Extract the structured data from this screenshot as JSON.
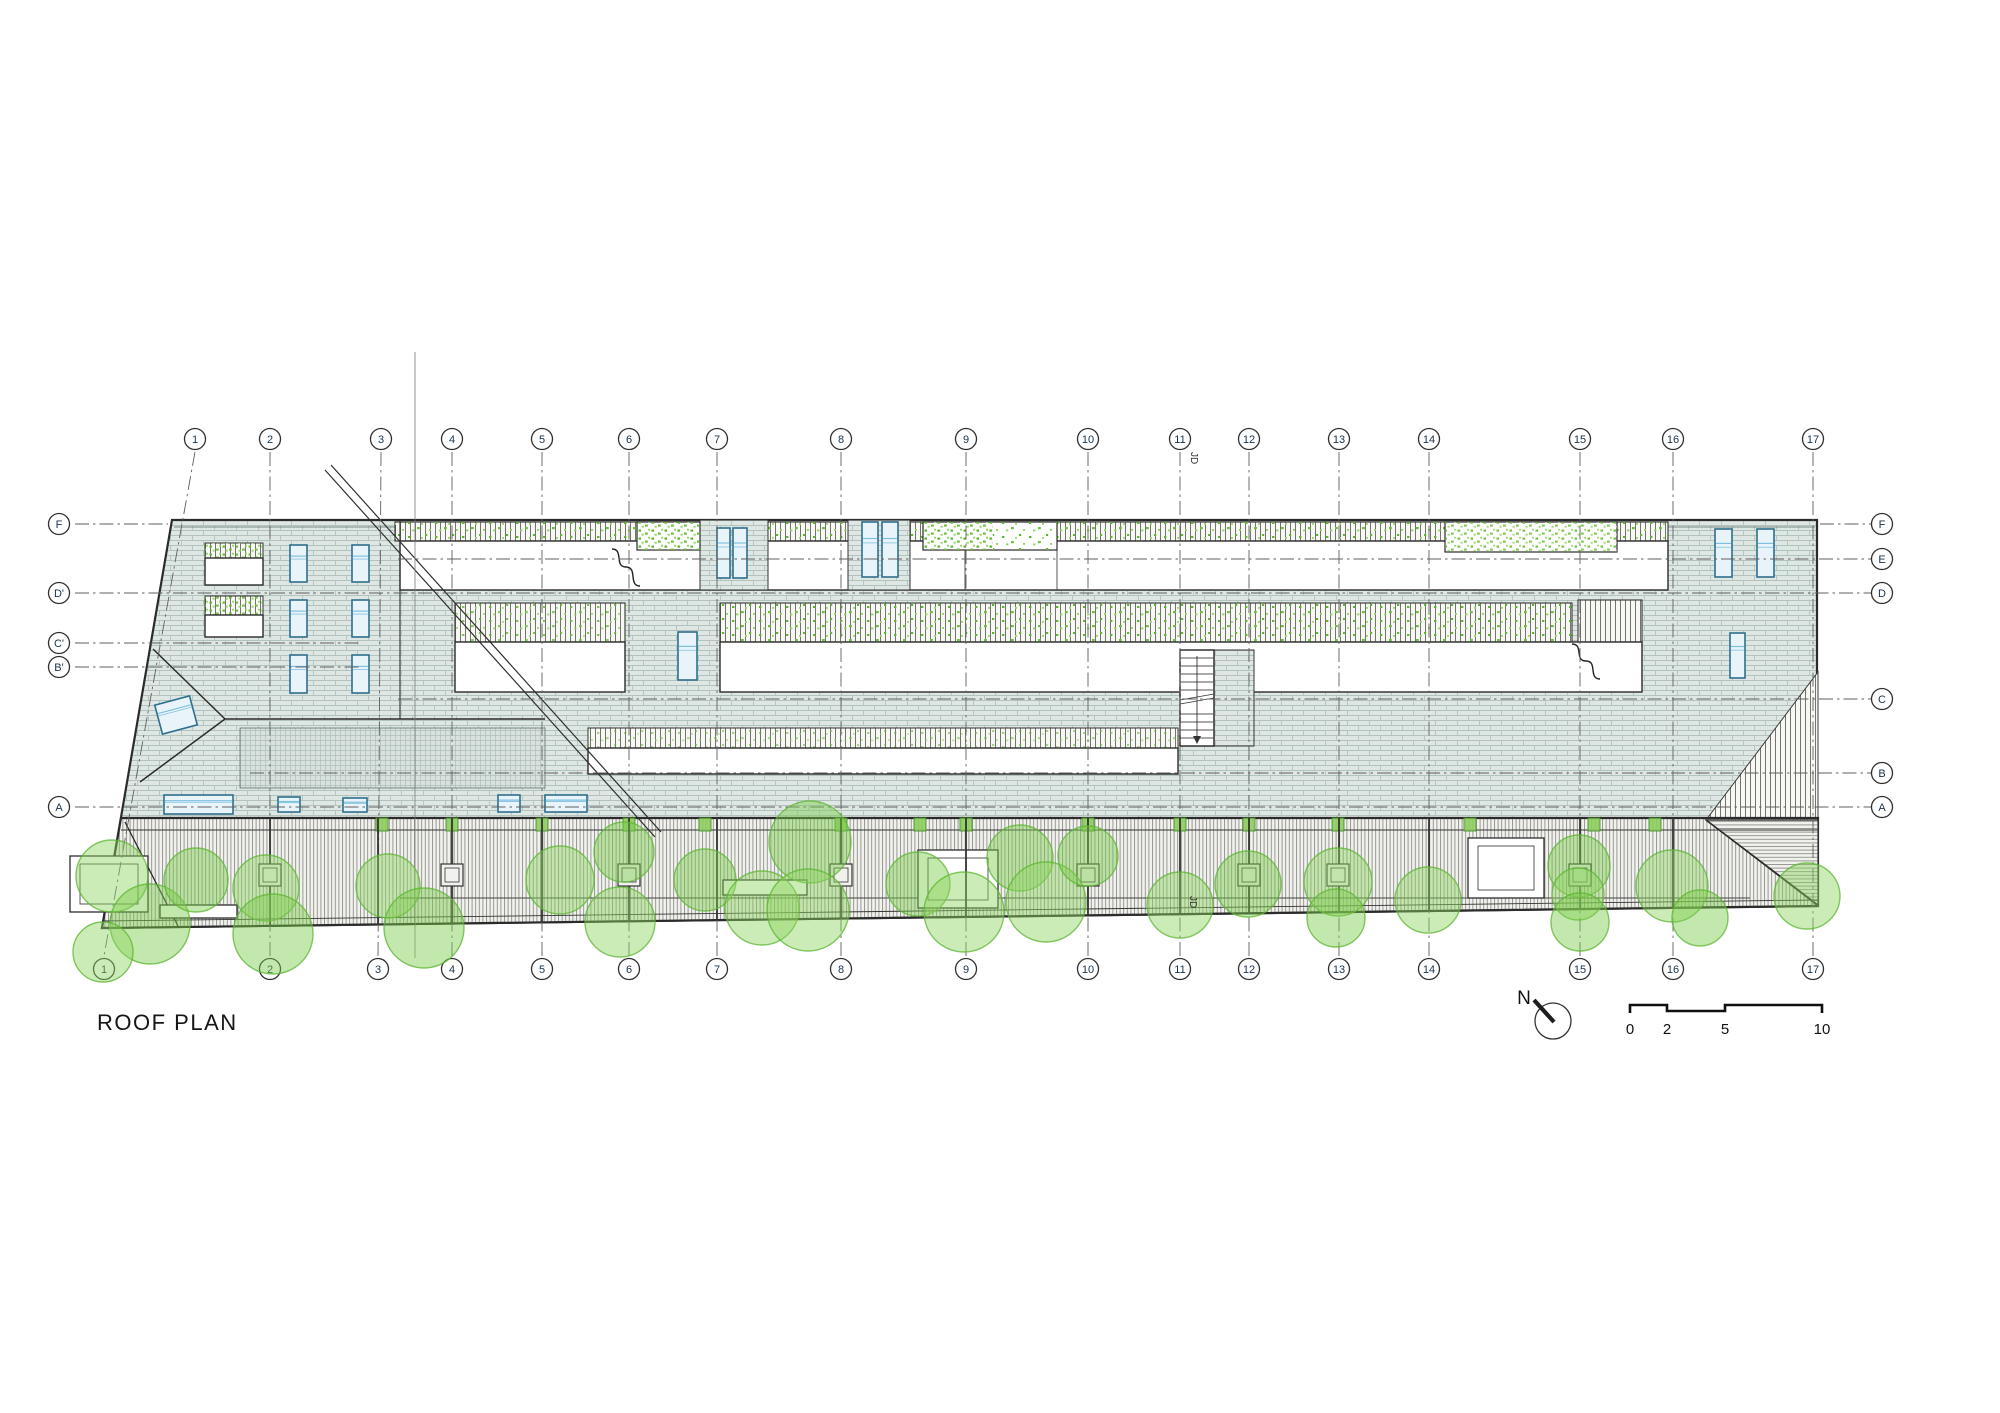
{
  "drawing": {
    "title": "ROOF PLAN",
    "north_label": "N",
    "section_label": "JD"
  },
  "colors": {
    "outline": "#2b2b2b",
    "grid_line": "#5f5f5f",
    "brick_bg": "#dee7e3",
    "brick_joint": "#b2c3bd",
    "deck_bg": "#f1f1ee",
    "deck_stripe": "#8d8d88",
    "green_dot_dark": "#5eb52f",
    "green_dot_light": "#8ed45f",
    "tree_fill": "#8ed45f",
    "tree_stroke": "#5cb631",
    "skylight_frame": "#2f6e8e",
    "skylight_fill": "#e9f4fa",
    "skylight_glaze": "#7fc0e0"
  },
  "grid": {
    "top_bubble_y": 439,
    "bottom_bubble_y": 969,
    "line_top_y": 452,
    "line_bottom_y": 956,
    "left_bubble_x": 59,
    "right_bubble_x": 1882,
    "columns": [
      {
        "label": "1",
        "x_top": 195,
        "x_bottom": 104
      },
      {
        "label": "2",
        "x_top": 270,
        "x_bottom": 270
      },
      {
        "label": "3",
        "x_top": 381,
        "x_bottom": 378
      },
      {
        "label": "4",
        "x_top": 452,
        "x_bottom": 452
      },
      {
        "label": "5",
        "x_top": 542,
        "x_bottom": 542
      },
      {
        "label": "6",
        "x_top": 629,
        "x_bottom": 629
      },
      {
        "label": "7",
        "x_top": 717,
        "x_bottom": 717
      },
      {
        "label": "8",
        "x_top": 841,
        "x_bottom": 841
      },
      {
        "label": "9",
        "x_top": 966,
        "x_bottom": 966
      },
      {
        "label": "10",
        "x_top": 1088,
        "x_bottom": 1088
      },
      {
        "label": "11",
        "x_top": 1180,
        "x_bottom": 1180
      },
      {
        "label": "12",
        "x_top": 1249,
        "x_bottom": 1249
      },
      {
        "label": "13",
        "x_top": 1339,
        "x_bottom": 1339
      },
      {
        "label": "14",
        "x_top": 1429,
        "x_bottom": 1429
      },
      {
        "label": "15",
        "x_top": 1580,
        "x_bottom": 1580
      },
      {
        "label": "16",
        "x_top": 1673,
        "x_bottom": 1673
      },
      {
        "label": "17",
        "x_top": 1813,
        "x_bottom": 1813
      }
    ],
    "rows": [
      {
        "y": 524,
        "left": "F",
        "right": "F",
        "segs": [
          [
            75,
            168
          ],
          [
            1820,
            1871
          ]
        ]
      },
      {
        "y": 559,
        "right": "E",
        "segs": [
          [
            398,
            1871
          ]
        ]
      },
      {
        "y": 593,
        "left": "D'",
        "right": "D",
        "segs": [
          [
            75,
            1871
          ]
        ]
      },
      {
        "y": 643,
        "left": "C'",
        "segs": [
          [
            75,
            360
          ]
        ]
      },
      {
        "y": 667,
        "left": "B'",
        "segs": [
          [
            75,
            360
          ]
        ]
      },
      {
        "y": 699,
        "right": "C",
        "segs": [
          [
            398,
            1871
          ]
        ]
      },
      {
        "y": 773,
        "right": "B",
        "segs": [
          [
            250,
            1871
          ]
        ]
      },
      {
        "y": 807,
        "left": "A",
        "right": "A",
        "segs": [
          [
            75,
            1871
          ]
        ]
      }
    ]
  },
  "scale_bar": {
    "labels": [
      {
        "text": "0",
        "x": 1630
      },
      {
        "text": "2",
        "x": 1667
      },
      {
        "text": "5",
        "x": 1725
      },
      {
        "text": "10",
        "x": 1822
      }
    ],
    "label_y": 1034
  },
  "trees": [
    [
      112,
      876,
      36
    ],
    [
      150,
      924,
      40
    ],
    [
      103,
      952,
      30
    ],
    [
      196,
      880,
      32
    ],
    [
      266,
      888,
      33
    ],
    [
      273,
      934,
      40
    ],
    [
      388,
      886,
      32
    ],
    [
      424,
      928,
      40
    ],
    [
      560,
      880,
      34
    ],
    [
      624,
      852,
      30
    ],
    [
      620,
      922,
      35
    ],
    [
      705,
      880,
      31
    ],
    [
      762,
      908,
      37
    ],
    [
      810,
      842,
      41
    ],
    [
      808,
      910,
      41
    ],
    [
      918,
      884,
      32
    ],
    [
      964,
      912,
      40
    ],
    [
      1020,
      858,
      33
    ],
    [
      1046,
      902,
      40
    ],
    [
      1088,
      856,
      30
    ],
    [
      1180,
      905,
      33
    ],
    [
      1248,
      884,
      33
    ],
    [
      1338,
      882,
      34
    ],
    [
      1336,
      918,
      29
    ],
    [
      1428,
      900,
      33
    ],
    [
      1579,
      866,
      31
    ],
    [
      1578,
      894,
      26
    ],
    [
      1580,
      922,
      29
    ],
    [
      1672,
      886,
      36
    ],
    [
      1700,
      918,
      28
    ],
    [
      1807,
      896,
      33
    ]
  ],
  "deck_pads": [
    382,
    452,
    542,
    629,
    705,
    841,
    920,
    966,
    1088,
    1180,
    1249,
    1338,
    1470,
    1594,
    1655
  ],
  "post_boxes": [
    270,
    452,
    629,
    841,
    1088,
    1249,
    1338,
    1580
  ],
  "skylights": [
    [
      290,
      545,
      17,
      37
    ],
    [
      352,
      545,
      17,
      37
    ],
    [
      290,
      600,
      17,
      37
    ],
    [
      352,
      600,
      17,
      37
    ],
    [
      290,
      655,
      17,
      38
    ],
    [
      352,
      655,
      17,
      38
    ],
    [
      158,
      700,
      36,
      30,
      -15
    ],
    [
      164,
      795,
      69,
      19
    ],
    [
      278,
      797,
      22,
      15
    ],
    [
      343,
      798,
      24,
      14
    ],
    [
      498,
      795,
      22,
      17
    ],
    [
      545,
      795,
      42,
      17
    ],
    [
      717,
      528,
      13,
      50
    ],
    [
      733,
      528,
      14,
      50
    ],
    [
      862,
      522,
      16,
      55
    ],
    [
      882,
      522,
      16,
      55
    ],
    [
      678,
      632,
      19,
      48
    ],
    [
      1715,
      529,
      17,
      48
    ],
    [
      1757,
      529,
      17,
      48
    ],
    [
      1730,
      633,
      15,
      45
    ]
  ]
}
